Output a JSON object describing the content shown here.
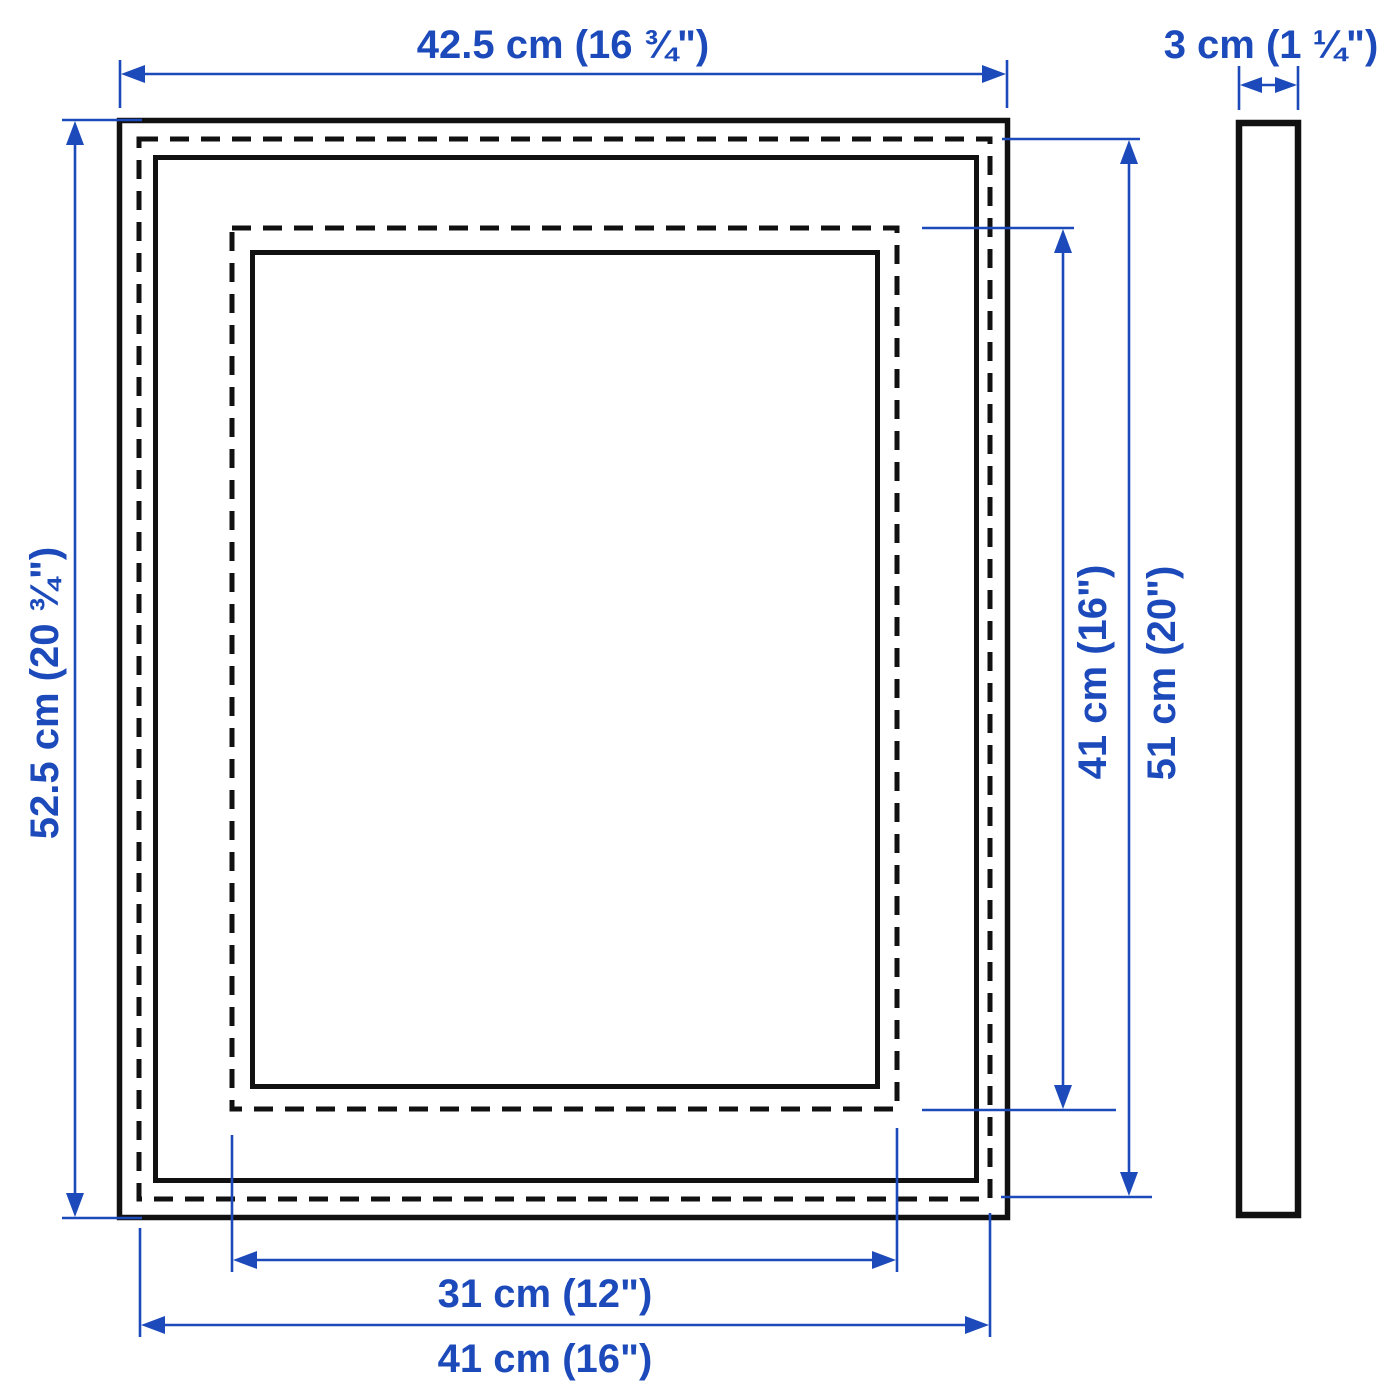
{
  "page": {
    "background_color": "#ffffff",
    "description": "Picture frame measurement diagram with front view and side profile"
  },
  "colors": {
    "dimension_blue": "#1c4aba",
    "outline_black": "#111111"
  },
  "dimensions": {
    "width_top": {
      "label": "42.5 cm (16 ¾\")",
      "value_cm": "42.5",
      "value_in": "16 ¾"
    },
    "height_left": {
      "label": "52.5 cm (20 ¾\")",
      "value_cm": "52.5",
      "value_in": "20 ¾"
    },
    "depth_top_right": {
      "label": "3 cm (1 ¼\")",
      "value_cm": "3",
      "value_in": "1 ¼"
    },
    "inner_height_right": {
      "label": "41 cm (16\")",
      "value_cm": "41",
      "value_in": "16"
    },
    "outer_height_right": {
      "label": "51 cm (20\")",
      "value_cm": "51",
      "value_in": "20"
    },
    "inner_width_bottom": {
      "label": "31 cm (12\")",
      "value_cm": "31",
      "value_in": "12"
    },
    "outer_width_bottom": {
      "label": "41 cm (16\")",
      "value_cm": "41",
      "value_in": "16"
    }
  }
}
